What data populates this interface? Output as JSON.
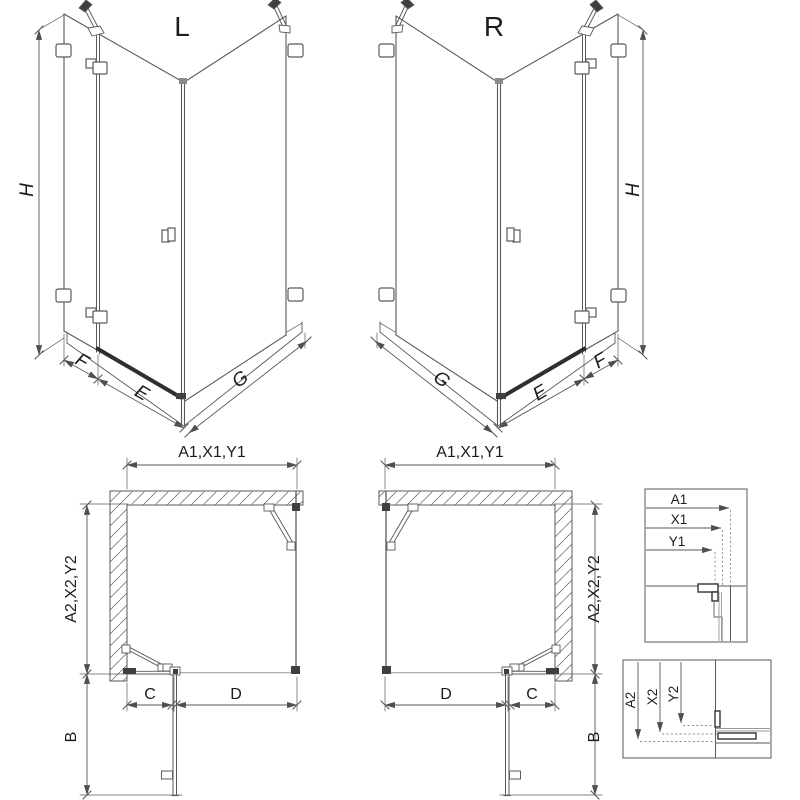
{
  "titles": {
    "left": "L",
    "right": "R"
  },
  "iso": {
    "height": "H",
    "front_fixed": "F",
    "front_door": "E",
    "side_panel": "G"
  },
  "plan": {
    "top_width": "A1,X1,Y1",
    "side_depth": "A2,X2,Y2",
    "fixed_segment": "C",
    "door_segment": "D",
    "swing_depth": "B"
  },
  "detail_top": {
    "a1": "A1",
    "x1": "X1",
    "y1": "Y1"
  },
  "detail_bottom": {
    "a2": "A2",
    "x2": "X2",
    "y2": "Y2"
  },
  "colors": {
    "background": "#ffffff",
    "line": "#5a5a5a",
    "hardware_dark": "#3f3f3f",
    "hatch": "#777777",
    "text": "#1c1c1c"
  }
}
